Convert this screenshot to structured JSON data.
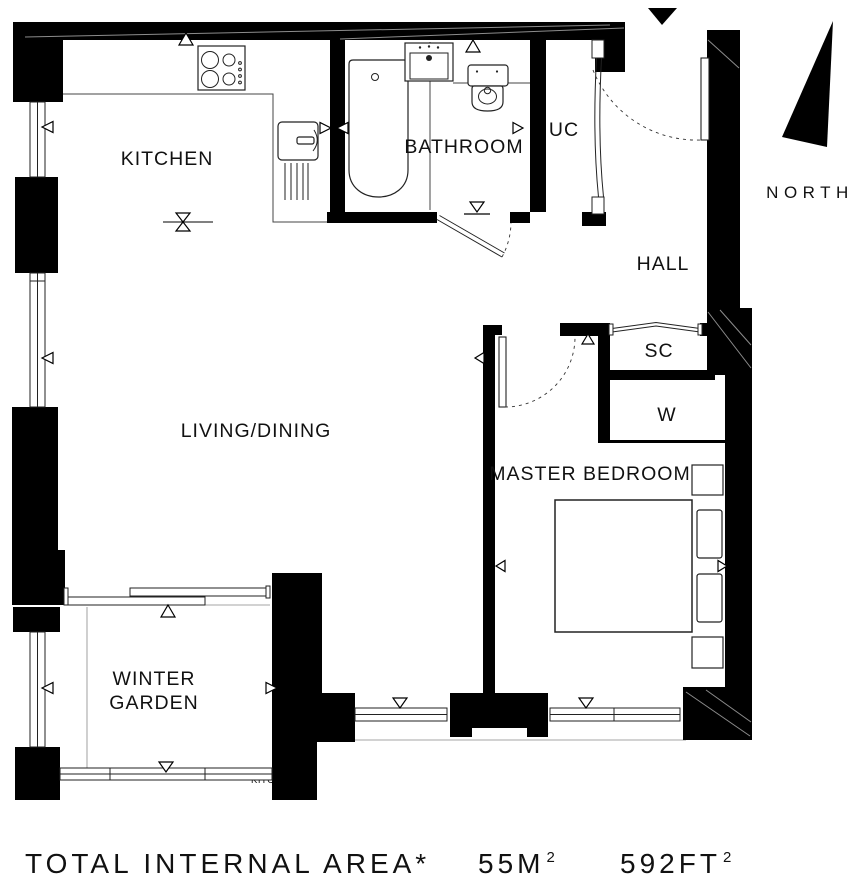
{
  "labels": {
    "kitchen": "KITCHEN",
    "bathroom": "BATHROOM",
    "uc": "UC",
    "hall": "HALL",
    "sc": "SC",
    "wardrobe": "W",
    "master_bedroom": "MASTER BEDROOM",
    "living_dining": "LIVING/DINING",
    "winter_garden_line1": "WINTER",
    "winter_garden_line2": "GARDEN",
    "north": "NORTH",
    "clipped_kitchen": "KITC"
  },
  "footer": {
    "title": "TOTAL INTERNAL AREA*",
    "metric": "55M",
    "metric_exponent": "2",
    "imperial": "592FT",
    "imperial_exponent": "2"
  },
  "colors": {
    "wall": "#000000",
    "floor": "#ffffff"
  }
}
